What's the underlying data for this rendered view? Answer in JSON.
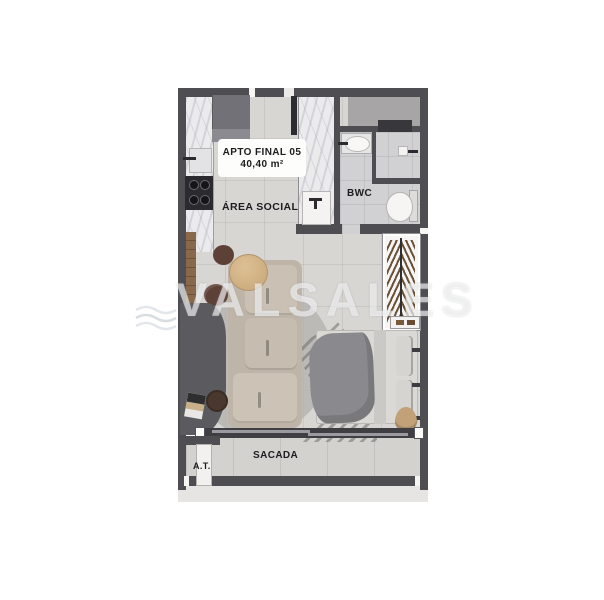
{
  "unit_card": {
    "title": "APTO FINAL 05",
    "area": "40,40 m²"
  },
  "labels": {
    "social_area": "ÁREA SOCIAL",
    "bathroom": "BWC",
    "balcony": "SACADA",
    "technical_area": "A.T."
  },
  "watermark": {
    "text": "VALSALES",
    "logo": "waves-logo-icon"
  },
  "colors": {
    "wall": "#4e4d52",
    "floor": "#d8d6d3",
    "bathroom_floor": "#d1d1d3",
    "balcony_floor": "#d4d2cf",
    "marble": "#ebebed",
    "shaft": "#a7a5a6",
    "sofa": "#c5bcaf",
    "bed_blanket": "#8a8a8e",
    "wood": "#8a684c",
    "label_text": "#1d1d1f",
    "watermark_text": "rgba(255,255,255,0.58)"
  },
  "furniture_shown": [
    "fridge",
    "kitchen-sink",
    "cooktop",
    "laundry-tub",
    "sofa",
    "coffee-table",
    "pouf",
    "rug",
    "desk",
    "laptop",
    "stool",
    "wardrobe-with-hangers",
    "bed",
    "bathroom-sink",
    "shower",
    "toilet",
    "balcony-sliding-door"
  ]
}
